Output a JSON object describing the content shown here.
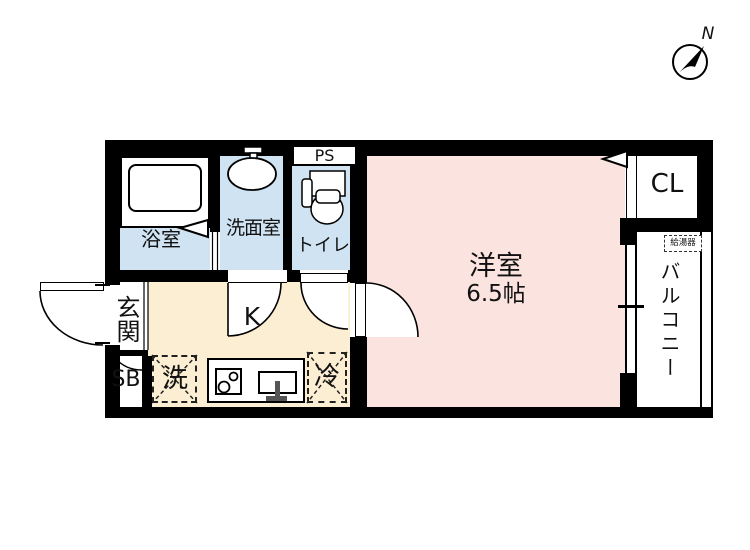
{
  "compass": {
    "north": "N"
  },
  "rooms": {
    "bathroom": {
      "label": "浴室"
    },
    "washroom": {
      "label": "洗面室"
    },
    "toilet": {
      "label": "トイレ"
    },
    "pipe_space": {
      "label": "PS"
    },
    "kitchen": {
      "label": "K"
    },
    "entrance": {
      "label": "玄関"
    },
    "shoe_box": {
      "label": "SB"
    },
    "western_room": {
      "label": "洋室",
      "size": "6.5帖"
    },
    "closet": {
      "label": "CL"
    },
    "balcony": {
      "label": "バルコニー"
    }
  },
  "fixtures": {
    "washer": {
      "label": "洗"
    },
    "fridge": {
      "label": "冷"
    },
    "water_heater": {
      "label": "給湯器"
    }
  },
  "colors": {
    "wet_area_floor": "#cfe3f2",
    "living_floor": "#fbe3e0",
    "kitchen_floor": "#fceed3",
    "wall": "#000000"
  }
}
